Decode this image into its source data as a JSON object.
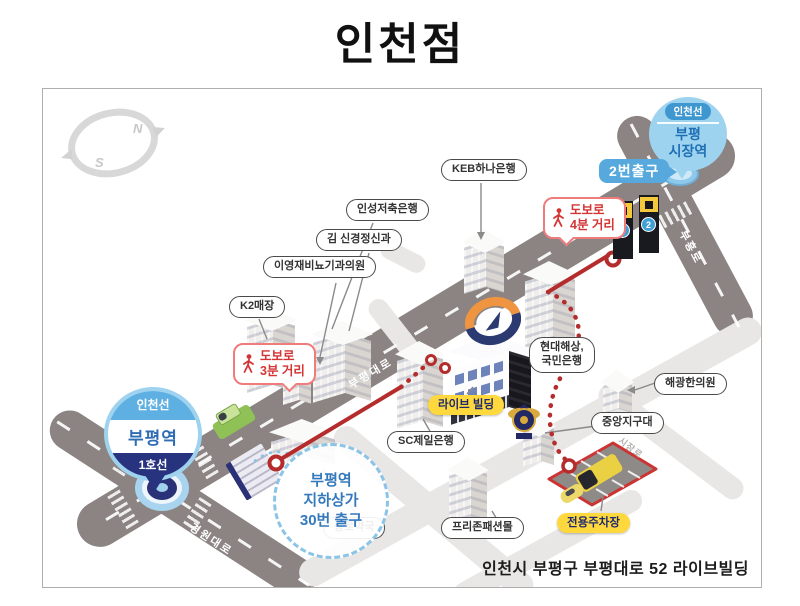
{
  "title": "인천점",
  "address": "인천시 부평구 부평대로 52 라이브빌딩",
  "compass": {
    "north": "N",
    "south": "S"
  },
  "stations": {
    "market": {
      "line_badge": "인천선",
      "name": "부평\n시장역",
      "exit_label": "2번출구",
      "exit_no": "2"
    },
    "bupyeong": {
      "line_badge": "인천선",
      "name": "부평역",
      "line2": "1호선"
    }
  },
  "walk_badges": [
    {
      "text": "도보로\n4분 거리"
    },
    {
      "text": "도보로\n3분 거리"
    }
  ],
  "underground_exit": {
    "text": "부평역\n지하상가\n30번 출구"
  },
  "landmarks": [
    {
      "text": "KEB하나은행"
    },
    {
      "text": "인성저축은행"
    },
    {
      "text": "김 신경정신과"
    },
    {
      "text": "이영재비뇨기과의원"
    },
    {
      "text": "K2매장"
    },
    {
      "text": "현대해상,\n국민은행"
    },
    {
      "text": "해광한의원"
    },
    {
      "text": "중앙지구대"
    },
    {
      "text": "SC제일은행"
    },
    {
      "text": "종로약국"
    },
    {
      "text": "프리존패션몰"
    }
  ],
  "highlights": [
    {
      "text": "라이브 빌딩"
    },
    {
      "text": "전용주차장"
    }
  ],
  "roads": [
    {
      "name": "부평대로"
    },
    {
      "name": "경원대로"
    },
    {
      "name": "부흥로"
    },
    {
      "name": "시장로"
    }
  ],
  "colors": {
    "route_red": "#b52c2c",
    "station_blue": "#57a9dd",
    "navy": "#27337f",
    "highlight_yellow": "#ffd83d",
    "road_dark": "#8b8482",
    "road_light": "#e9e7e5"
  }
}
